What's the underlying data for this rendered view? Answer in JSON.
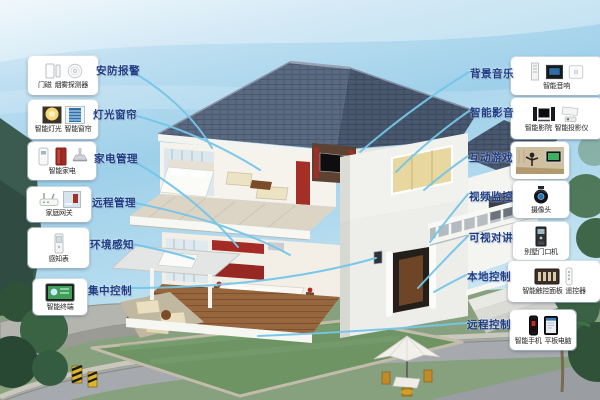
{
  "left_callouts": [
    {
      "label": "安防报警",
      "items": [
        {
          "caption": "门磁"
        },
        {
          "caption": "烟雾探测器"
        }
      ]
    },
    {
      "label": "灯光窗帘",
      "items": [
        {
          "caption": "智能灯光"
        },
        {
          "caption": "智能窗帘"
        }
      ]
    },
    {
      "label": "家电管理",
      "items": [
        {
          "caption": "智能家电"
        }
      ]
    },
    {
      "label": "远程管理",
      "items": [
        {
          "caption": "家庭网关"
        }
      ]
    },
    {
      "label": "环境感知",
      "items": [
        {
          "caption": "感知表"
        }
      ]
    },
    {
      "label": "集中控制",
      "items": [
        {
          "caption": "智能终端"
        }
      ]
    }
  ],
  "right_callouts": [
    {
      "label": "背景音乐",
      "items": [
        {
          "caption": "智能音响"
        }
      ]
    },
    {
      "label": "智能影音",
      "items": [
        {
          "caption": "智能影院"
        },
        {
          "caption": "智能投影仪"
        }
      ]
    },
    {
      "label": "互动游戏",
      "items": []
    },
    {
      "label": "视频监控",
      "items": [
        {
          "caption": "摄像头"
        }
      ]
    },
    {
      "label": "可视对讲",
      "items": [
        {
          "caption": "别墅门口机"
        }
      ]
    },
    {
      "label": "本地控制",
      "items": [
        {
          "caption": "智能触控面板"
        },
        {
          "caption": "遥控器"
        }
      ]
    },
    {
      "label": "远程控制",
      "items": [
        {
          "caption": "智能手机"
        },
        {
          "caption": "平板电脑"
        }
      ]
    }
  ],
  "colors": {
    "label_text": "#1c3c86",
    "connector_line": "#74c6e9",
    "box_background": "#ffffff",
    "roof": "#55647a",
    "sky_top": "#cfe9f5",
    "lawn": "#6e9464"
  }
}
